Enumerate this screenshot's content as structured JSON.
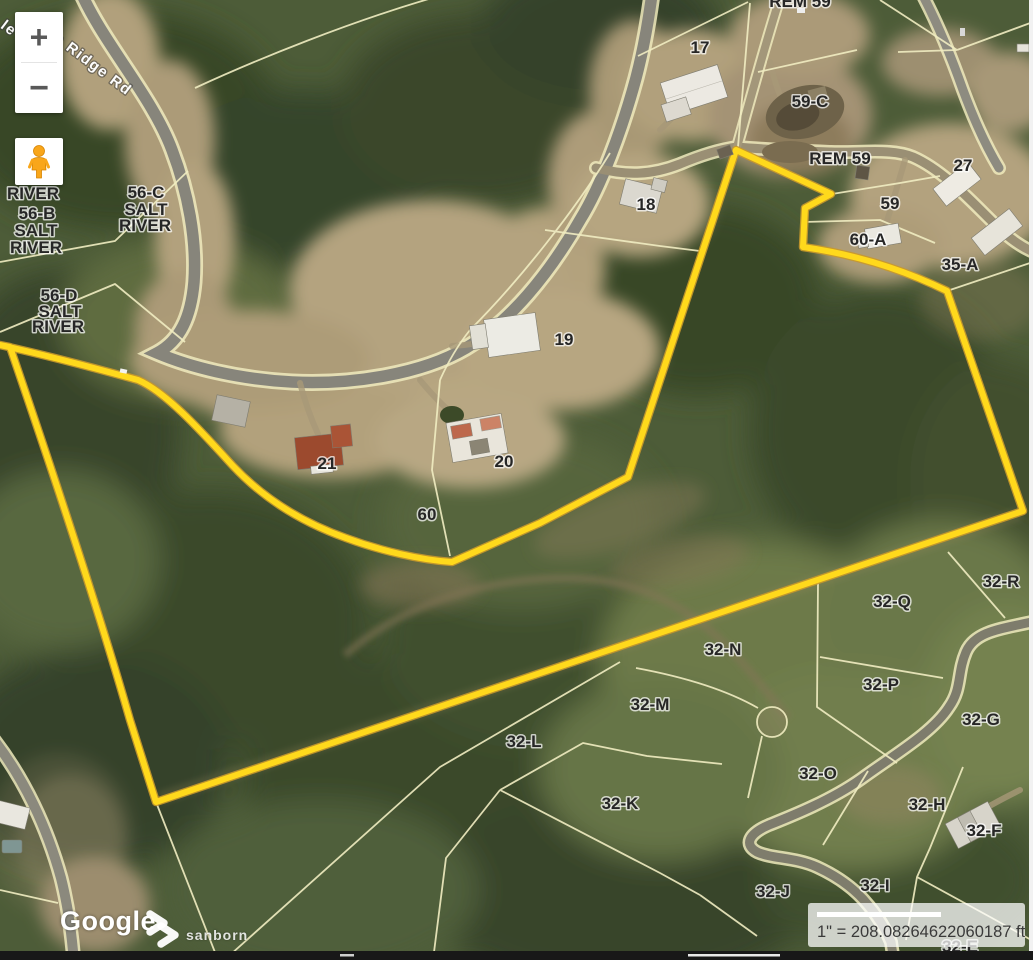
{
  "map": {
    "road_label": "s Ridge Rd",
    "road_label_fragment": "le",
    "controls": {
      "zoom_in": "+",
      "zoom_out": "−"
    },
    "attribution": {
      "google": "Google",
      "sanborn": "sanborn"
    },
    "scale": {
      "text": "1\" = 208.08264622060187 ft"
    },
    "highlight_color": "#ffd91c",
    "parcel_line_color": "#f1edc2"
  },
  "parcel_labels": [
    {
      "text": "REM 59",
      "x": 800,
      "y": 7
    },
    {
      "text": "17",
      "x": 700,
      "y": 53
    },
    {
      "text": "59-C",
      "x": 810,
      "y": 107
    },
    {
      "text": "REM 59",
      "x": 840,
      "y": 164
    },
    {
      "text": "27",
      "x": 963,
      "y": 171
    },
    {
      "text": "59",
      "x": 890,
      "y": 209
    },
    {
      "text": "60-A",
      "x": 868,
      "y": 245
    },
    {
      "text": "35-A",
      "x": 960,
      "y": 270
    },
    {
      "text": "18",
      "x": 646,
      "y": 210
    },
    {
      "text": "19",
      "x": 564,
      "y": 345
    },
    {
      "text": "20",
      "x": 504,
      "y": 467
    },
    {
      "text": "21",
      "x": 327,
      "y": 469
    },
    {
      "text": "60",
      "x": 427,
      "y": 520
    },
    {
      "text": "RIVER",
      "x": 33,
      "y": 199,
      "size": 15
    },
    {
      "text": "56-B",
      "x": 37,
      "y": 219,
      "size": 15
    },
    {
      "text": "SALT",
      "x": 36,
      "y": 236,
      "size": 15
    },
    {
      "text": "RIVER",
      "x": 36,
      "y": 253,
      "size": 15
    },
    {
      "text": "56-C",
      "x": 146,
      "y": 198,
      "size": 15
    },
    {
      "text": "SALT",
      "x": 146,
      "y": 215,
      "size": 15
    },
    {
      "text": "RIVER",
      "x": 145,
      "y": 231,
      "size": 15
    },
    {
      "text": "56-D",
      "x": 59,
      "y": 301,
      "size": 15
    },
    {
      "text": "SALT",
      "x": 60,
      "y": 317,
      "size": 15
    },
    {
      "text": "RIVER",
      "x": 58,
      "y": 332,
      "size": 15
    },
    {
      "text": "32-R",
      "x": 1001,
      "y": 587
    },
    {
      "text": "32-Q",
      "x": 892,
      "y": 607
    },
    {
      "text": "32-N",
      "x": 723,
      "y": 655
    },
    {
      "text": "32-P",
      "x": 881,
      "y": 690
    },
    {
      "text": "32-M",
      "x": 650,
      "y": 710
    },
    {
      "text": "32-G",
      "x": 981,
      "y": 725
    },
    {
      "text": "32-L",
      "x": 524,
      "y": 747
    },
    {
      "text": "32-O",
      "x": 818,
      "y": 779
    },
    {
      "text": "32-K",
      "x": 620,
      "y": 809
    },
    {
      "text": "32-H",
      "x": 927,
      "y": 810
    },
    {
      "text": "32-F",
      "x": 984,
      "y": 836
    },
    {
      "text": "32-I",
      "x": 875,
      "y": 891
    },
    {
      "text": "32-J",
      "x": 773,
      "y": 897
    },
    {
      "text": "32-E",
      "x": 960,
      "y": 952
    }
  ]
}
